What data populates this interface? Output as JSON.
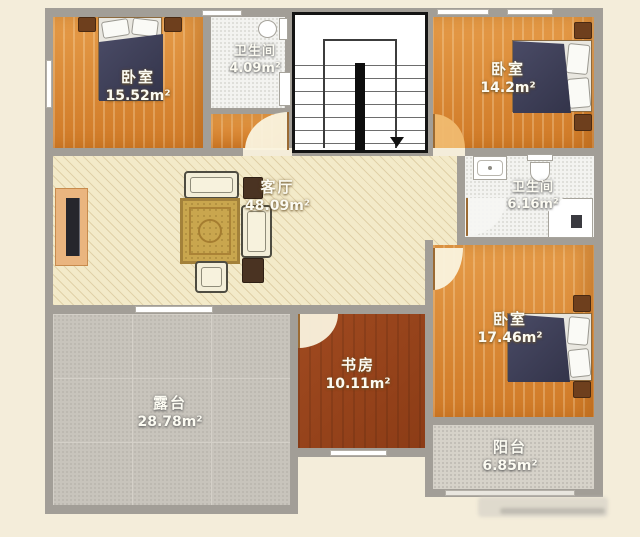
{
  "plan": {
    "type": "residential-floor-plan",
    "rooms": {
      "bedroom_top_left": {
        "name": "卧室",
        "area": "15.52m²"
      },
      "bathroom_top": {
        "name": "卫生间",
        "area": "4.09m²"
      },
      "bedroom_top_right": {
        "name": "卧室",
        "area": "14.2m²"
      },
      "bathroom_right": {
        "name": "卫生间",
        "area": "6.16m²"
      },
      "living_room": {
        "name": "客厅",
        "area": "48.09m²"
      },
      "terrace": {
        "name": "露台",
        "area": "28.78m²"
      },
      "study": {
        "name": "书房",
        "area": "10.11m²"
      },
      "bedroom_bottom_right": {
        "name": "卧室",
        "area": "17.46m²"
      },
      "balcony": {
        "name": "阳台",
        "area": "6.85m²"
      }
    },
    "colors": {
      "wall": "#a29e97",
      "bedroom_floor": "#e0923e",
      "living_floor": "#f3eac9",
      "study_floor": "#9a431c",
      "terrace_floor": "#c8c4bc",
      "balcony_floor": "#d6d2c9",
      "bath_floor": "#f3f3f0",
      "margin": "#f4edda",
      "label_text": "#fcfbf2"
    }
  }
}
